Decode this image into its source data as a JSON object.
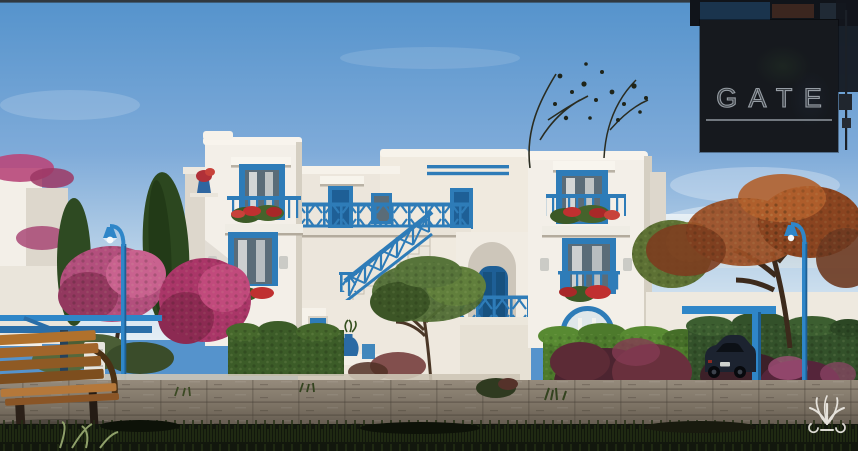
{
  "branding": {
    "logo_text": "GATE",
    "logo_text_color": "#969da4",
    "logo_bg": "#16191e",
    "logo_underline_color": "#838a91"
  },
  "watermark": {
    "icon": "palm-emblem",
    "color": "#f5f2ec"
  },
  "scene": {
    "type": "architectural-exterior-render",
    "subject": "white mediterranean two-storey duplex with blue doors, windows, railings and external staircase",
    "elements": [
      "left-tower",
      "center-balcony",
      "staircase",
      "arched-doorway",
      "right-tower",
      "flower-boxes",
      "street-lamps",
      "pergolas",
      "parked-car",
      "wooden-bench",
      "hedges",
      "pink-trees",
      "cypress-trees",
      "autumn-tree",
      "stone-path",
      "foreground-grass",
      "blue-amphora"
    ]
  },
  "colors": {
    "sky_top": "#5593cc",
    "sky_mid": "#8cb5de",
    "sky_horizon": "#dce8f1",
    "sea": "#c2d3de",
    "wall_sunlit": "#f3efe8",
    "wall_shaded": "#ddd7cc",
    "wall_dark": "#c6bfb2",
    "accent_blue": "#2e7cb8",
    "accent_blue_dark": "#1e5f96",
    "glass_dark": "#5a6c78",
    "curtain": "#e9e9e6",
    "hedge_green": "#4a7230",
    "hedge_dark": "#2f4d1f",
    "cypress_green": "#2c471f",
    "pink_tree": "#c25587",
    "magenta_bush": "#b03a6e",
    "autumn_orange": "#a2542a",
    "autumn_dark": "#6e3a20",
    "red_flower": "#c03030",
    "wood_bench": "#a8692c",
    "wood_bench_dark": "#6e4119",
    "pavement": "#867a6c",
    "pavement_dark": "#5f574d",
    "grass_dark": "#12170d",
    "lamp_blue": "#2f86c8",
    "car_body": "#1c2330",
    "top_strip": "#2e3338"
  }
}
